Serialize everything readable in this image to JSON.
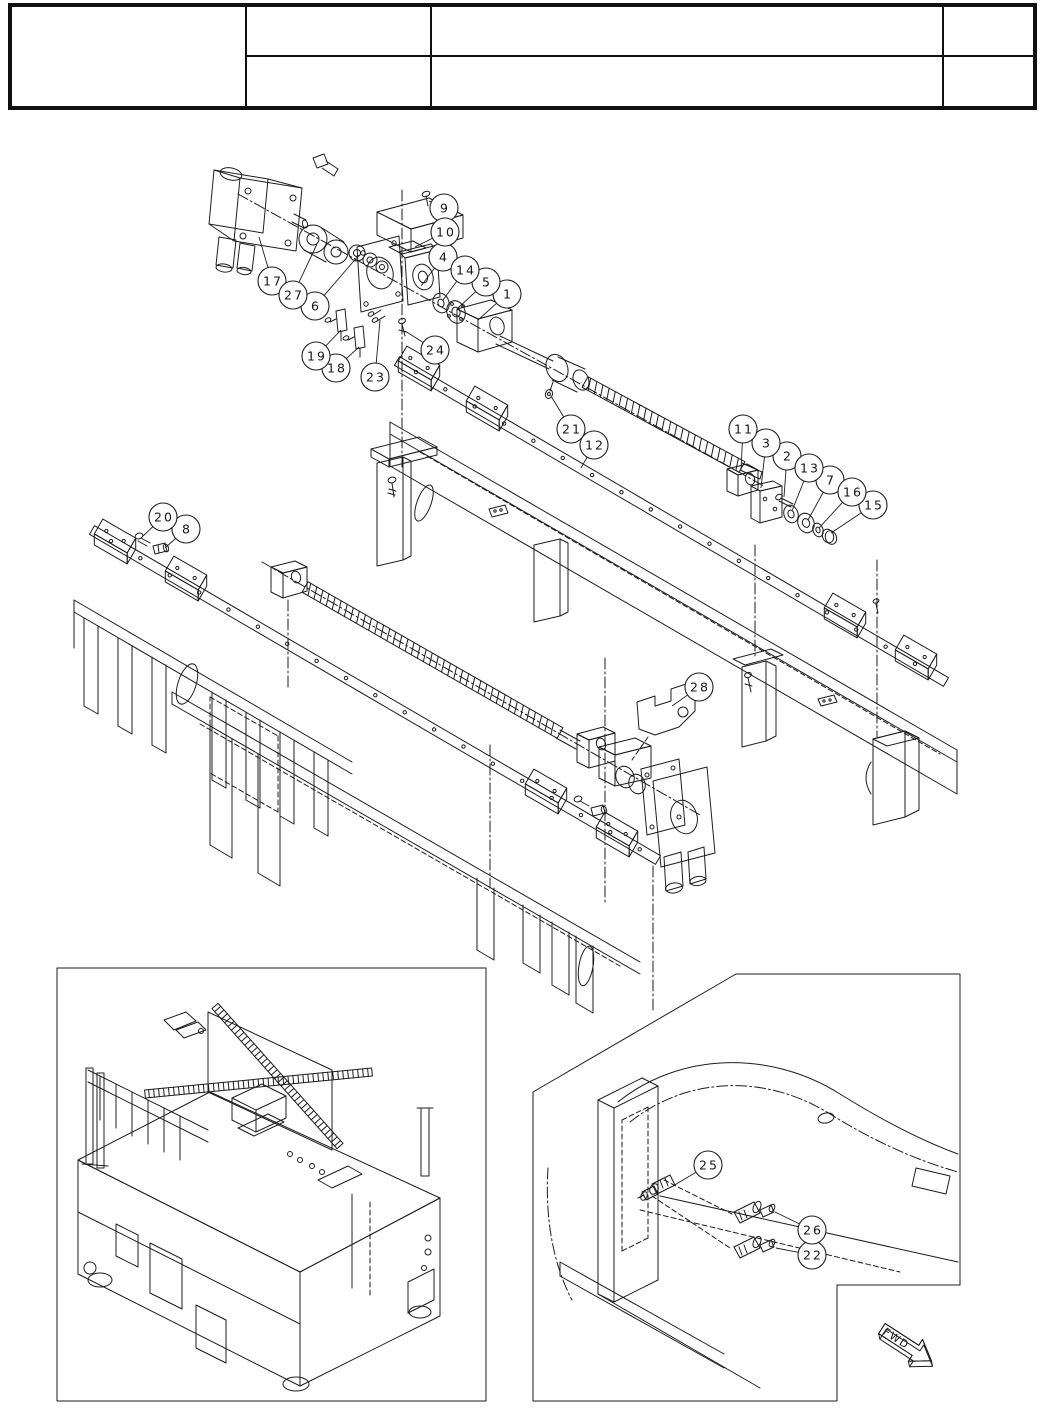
{
  "page": {
    "background": "#ffffff",
    "ink": "#1d1d1d",
    "kind": "exploded-parts-diagram-page"
  },
  "title_block": {
    "cells": [
      {
        "id": "left-merged",
        "text": ""
      },
      {
        "id": "col2-row1",
        "text": ""
      },
      {
        "id": "col3-row1",
        "text": ""
      },
      {
        "id": "col4-row1",
        "text": ""
      },
      {
        "id": "col2-row2",
        "text": ""
      },
      {
        "id": "col3-row2",
        "text": ""
      },
      {
        "id": "col4-row2",
        "text": ""
      }
    ]
  },
  "drawing": {
    "type": "exploded-parts-diagram",
    "fwd_label": "FWD",
    "callouts": [
      {
        "id": "1",
        "label": "1",
        "x": 507,
        "y": 294,
        "tx": 478,
        "ty": 320
      },
      {
        "id": "2",
        "label": "2",
        "x": 787,
        "y": 456,
        "tx": 784,
        "ty": 497
      },
      {
        "id": "3",
        "label": "3",
        "x": 766,
        "y": 443,
        "tx": 761,
        "ty": 488
      },
      {
        "id": "4",
        "label": "4",
        "x": 443,
        "y": 257,
        "tx": 421,
        "ty": 286
      },
      {
        "id": "5",
        "label": "5",
        "x": 486,
        "y": 282,
        "tx": 458,
        "ty": 308
      },
      {
        "id": "6",
        "label": "6",
        "x": 315,
        "y": 306,
        "tx": 359,
        "ty": 255
      },
      {
        "id": "7",
        "label": "7",
        "x": 830,
        "y": 480,
        "tx": 808,
        "ty": 520
      },
      {
        "id": "8",
        "label": "8",
        "x": 186,
        "y": 529,
        "tx": 165,
        "ty": 548
      },
      {
        "id": "9",
        "label": "9",
        "x": 444,
        "y": 208,
        "tx": 429,
        "ty": 201
      },
      {
        "id": "10",
        "label": "10",
        "x": 445,
        "y": 232,
        "tx": 415,
        "ty": 247
      },
      {
        "id": "11",
        "label": "11",
        "x": 743,
        "y": 429,
        "tx": 741,
        "ty": 470
      },
      {
        "id": "12",
        "label": "12",
        "x": 594,
        "y": 445,
        "tx": 581,
        "ty": 468
      },
      {
        "id": "13",
        "label": "13",
        "x": 809,
        "y": 468,
        "tx": 792,
        "ty": 511
      },
      {
        "id": "14",
        "label": "14",
        "x": 465,
        "y": 270,
        "tx": 443,
        "ty": 300
      },
      {
        "id": "15",
        "label": "15",
        "x": 873,
        "y": 505,
        "tx": 831,
        "ty": 533
      },
      {
        "id": "16",
        "label": "16",
        "x": 852,
        "y": 492,
        "tx": 819,
        "ty": 528
      },
      {
        "id": "17",
        "label": "17",
        "x": 272,
        "y": 281,
        "tx": 259,
        "ty": 237
      },
      {
        "id": "18",
        "label": "18",
        "x": 336,
        "y": 368,
        "tx": 359,
        "ty": 347
      },
      {
        "id": "19",
        "label": "19",
        "x": 316,
        "y": 356,
        "tx": 341,
        "ty": 330
      },
      {
        "id": "20",
        "label": "20",
        "x": 163,
        "y": 517,
        "tx": 142,
        "ty": 537
      },
      {
        "id": "21",
        "label": "21",
        "x": 571,
        "y": 429,
        "tx": 551,
        "ty": 396
      },
      {
        "id": "22",
        "label": "22",
        "x": 812,
        "y": 1255,
        "tx": 776,
        "ty": 1248
      },
      {
        "id": "23",
        "label": "23",
        "x": 375,
        "y": 377,
        "tx": 380,
        "ty": 320
      },
      {
        "id": "24",
        "label": "24",
        "x": 435,
        "y": 350,
        "tx": 405,
        "ty": 331
      },
      {
        "id": "25",
        "label": "25",
        "x": 708,
        "y": 1165,
        "tx": 673,
        "ty": 1186
      },
      {
        "id": "26",
        "label": "26",
        "x": 812,
        "y": 1230,
        "tx": 775,
        "ty": 1212
      },
      {
        "id": "27",
        "label": "27",
        "x": 293,
        "y": 295,
        "tx": 317,
        "ty": 244
      },
      {
        "id": "28",
        "label": "28",
        "x": 699,
        "y": 687,
        "tx": 672,
        "ty": 706
      }
    ]
  }
}
